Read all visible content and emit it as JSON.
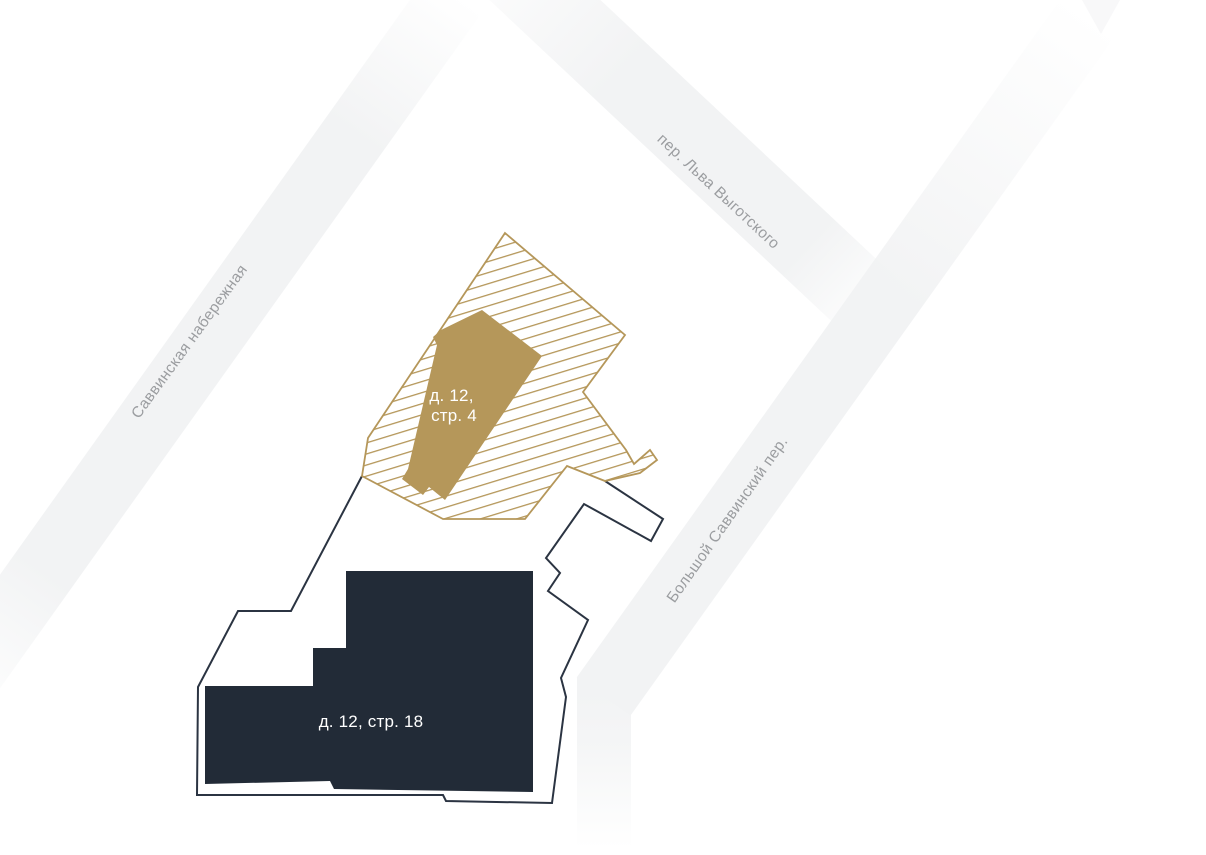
{
  "canvas": {
    "background": "#ffffff"
  },
  "streets": [
    {
      "id": "savvinskaya-naberezhnaya",
      "name": "Саввинская набережная"
    },
    {
      "id": "per-lva-vygotskogo",
      "name": "пер. Льва Выготского"
    },
    {
      "id": "bolshoy-savvinsky-per",
      "name": "Большой Саввинский пер."
    }
  ],
  "buildings": [
    {
      "id": "d12-s4",
      "label_lines": [
        "д. 12,",
        "стр. 4"
      ],
      "highlighted": true
    },
    {
      "id": "d12-s18",
      "label": "д. 12, стр. 18",
      "highlighted": false
    }
  ],
  "colors": {
    "background": "#ffffff",
    "street_band": "#f2f3f4",
    "street_label": "#9b9da0",
    "gold": "#b5975a",
    "building_dark": "#222b37",
    "parcel_outline": "#2b3442",
    "building_label": "#ffffff"
  }
}
